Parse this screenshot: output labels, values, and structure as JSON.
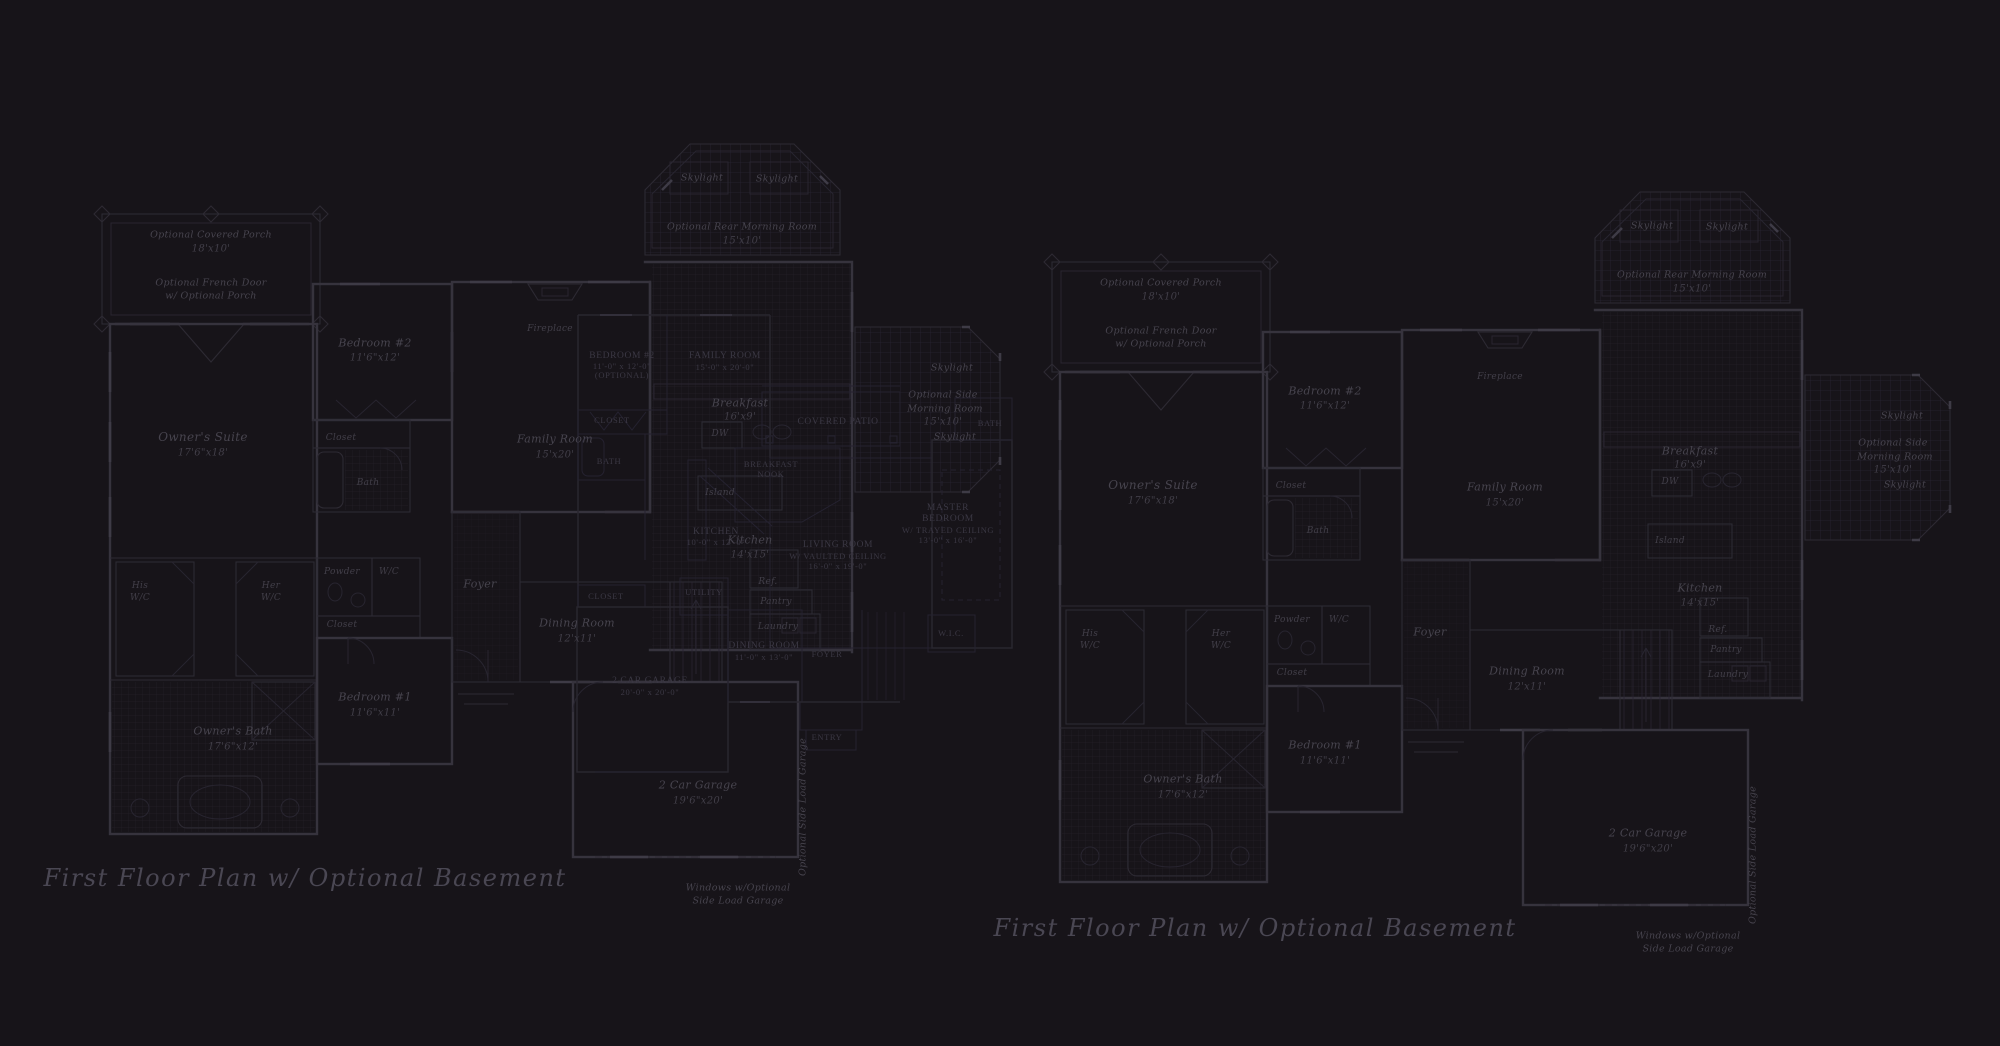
{
  "captions": {
    "left": "First Floor Plan  w/ Optional Basement",
    "right": "First Floor Plan  w/ Optional Basement"
  },
  "colors": {
    "background": "#171419",
    "wall_line": "#36333d",
    "thin_line": "#2d2a33",
    "overlay_line": "#29262f",
    "label_text": "#47444e",
    "caption_text": "#4a4753",
    "tile_line": "#221f28"
  },
  "plan": {
    "covered_porch": "Optional Covered Porch",
    "covered_porch_dim": "18'x10'",
    "french_door_1": "Optional French Door",
    "french_door_2": "w/ Optional Porch",
    "owners_suite": "Owner's Suite",
    "owners_suite_dim": "17'6\"x18'",
    "bedroom2": "Bedroom #2",
    "bedroom2_dim": "11'6\"x12'",
    "closet": "Closet",
    "bath": "Bath",
    "skylight": "Skylight",
    "rear_morning_room": "Optional Rear Morning Room",
    "rear_morning_room_dim": "15'x10'",
    "fireplace": "Fireplace",
    "family_room": "Family Room",
    "family_room_dim": "15'x20'",
    "breakfast": "Breakfast",
    "breakfast_dim": "16'x9'",
    "dw": "DW",
    "island": "Island",
    "kitchen": "Kitchen",
    "kitchen_dim": "14'x15'",
    "ref": "Ref.",
    "pantry": "Pantry",
    "laundry": "Laundry",
    "his": "His",
    "her": "Her",
    "wc": "W/C",
    "powder": "Powder",
    "closet2": "Closet",
    "owners_bath": "Owner's Bath",
    "owners_bath_dim": "17'6\"x12'",
    "bedroom1": "Bedroom #1",
    "bedroom1_dim": "11'6\"x11'",
    "foyer": "Foyer",
    "dining_room": "Dining Room",
    "dining_room_dim": "12'x11'",
    "garage": "2 Car Garage",
    "garage_dim": "19'6\"x20'",
    "side_load_garage": "Optional Side Load Garage",
    "windows_note_1": "Windows w/Optional",
    "windows_note_2": "Side Load Garage",
    "side_morning_1": "Optional Side",
    "side_morning_2": "Morning Room",
    "side_morning_dim": "15'x10'"
  },
  "overlay": {
    "bedroom2": "BEDROOM #2",
    "bedroom2_dim": "11'-0\" x 12'-0\"",
    "bedroom2_note": "(OPTIONAL)",
    "family_room": "FAMILY ROOM",
    "family_room_dim": "15'-0\" x 20'-0\"",
    "closet": "CLOSET",
    "bath": "BATH",
    "covered_patio": "COVERED PATIO",
    "breakfast_nook_1": "BREAKFAST",
    "breakfast_nook_2": "NOOK",
    "kitchen": "KITCHEN",
    "kitchen_dim": "10'-0\" x 12'-0\"",
    "living_room": "LIVING ROOM",
    "living_room_note": "W/ VAULTED CEILING",
    "living_room_dim": "16'-0\" x 19'-0\"",
    "master_1": "MASTER",
    "master_2": "BEDROOM",
    "master_note": "W/ TRAYED CEILING",
    "master_dim": "13'-0\" x 16'-0\"",
    "utility": "UTILITY",
    "wic": "W.I.C.",
    "master_bath": "BATH",
    "closet_g": "CLOSET",
    "garage": "2 CAR GARAGE",
    "garage_dim": "20'-0\" x 20'-0\"",
    "dining": "DINING ROOM",
    "dining_dim": "11'-0\" x 13'-0\"",
    "foyer": "FOYER",
    "entry": "ENTRY"
  }
}
